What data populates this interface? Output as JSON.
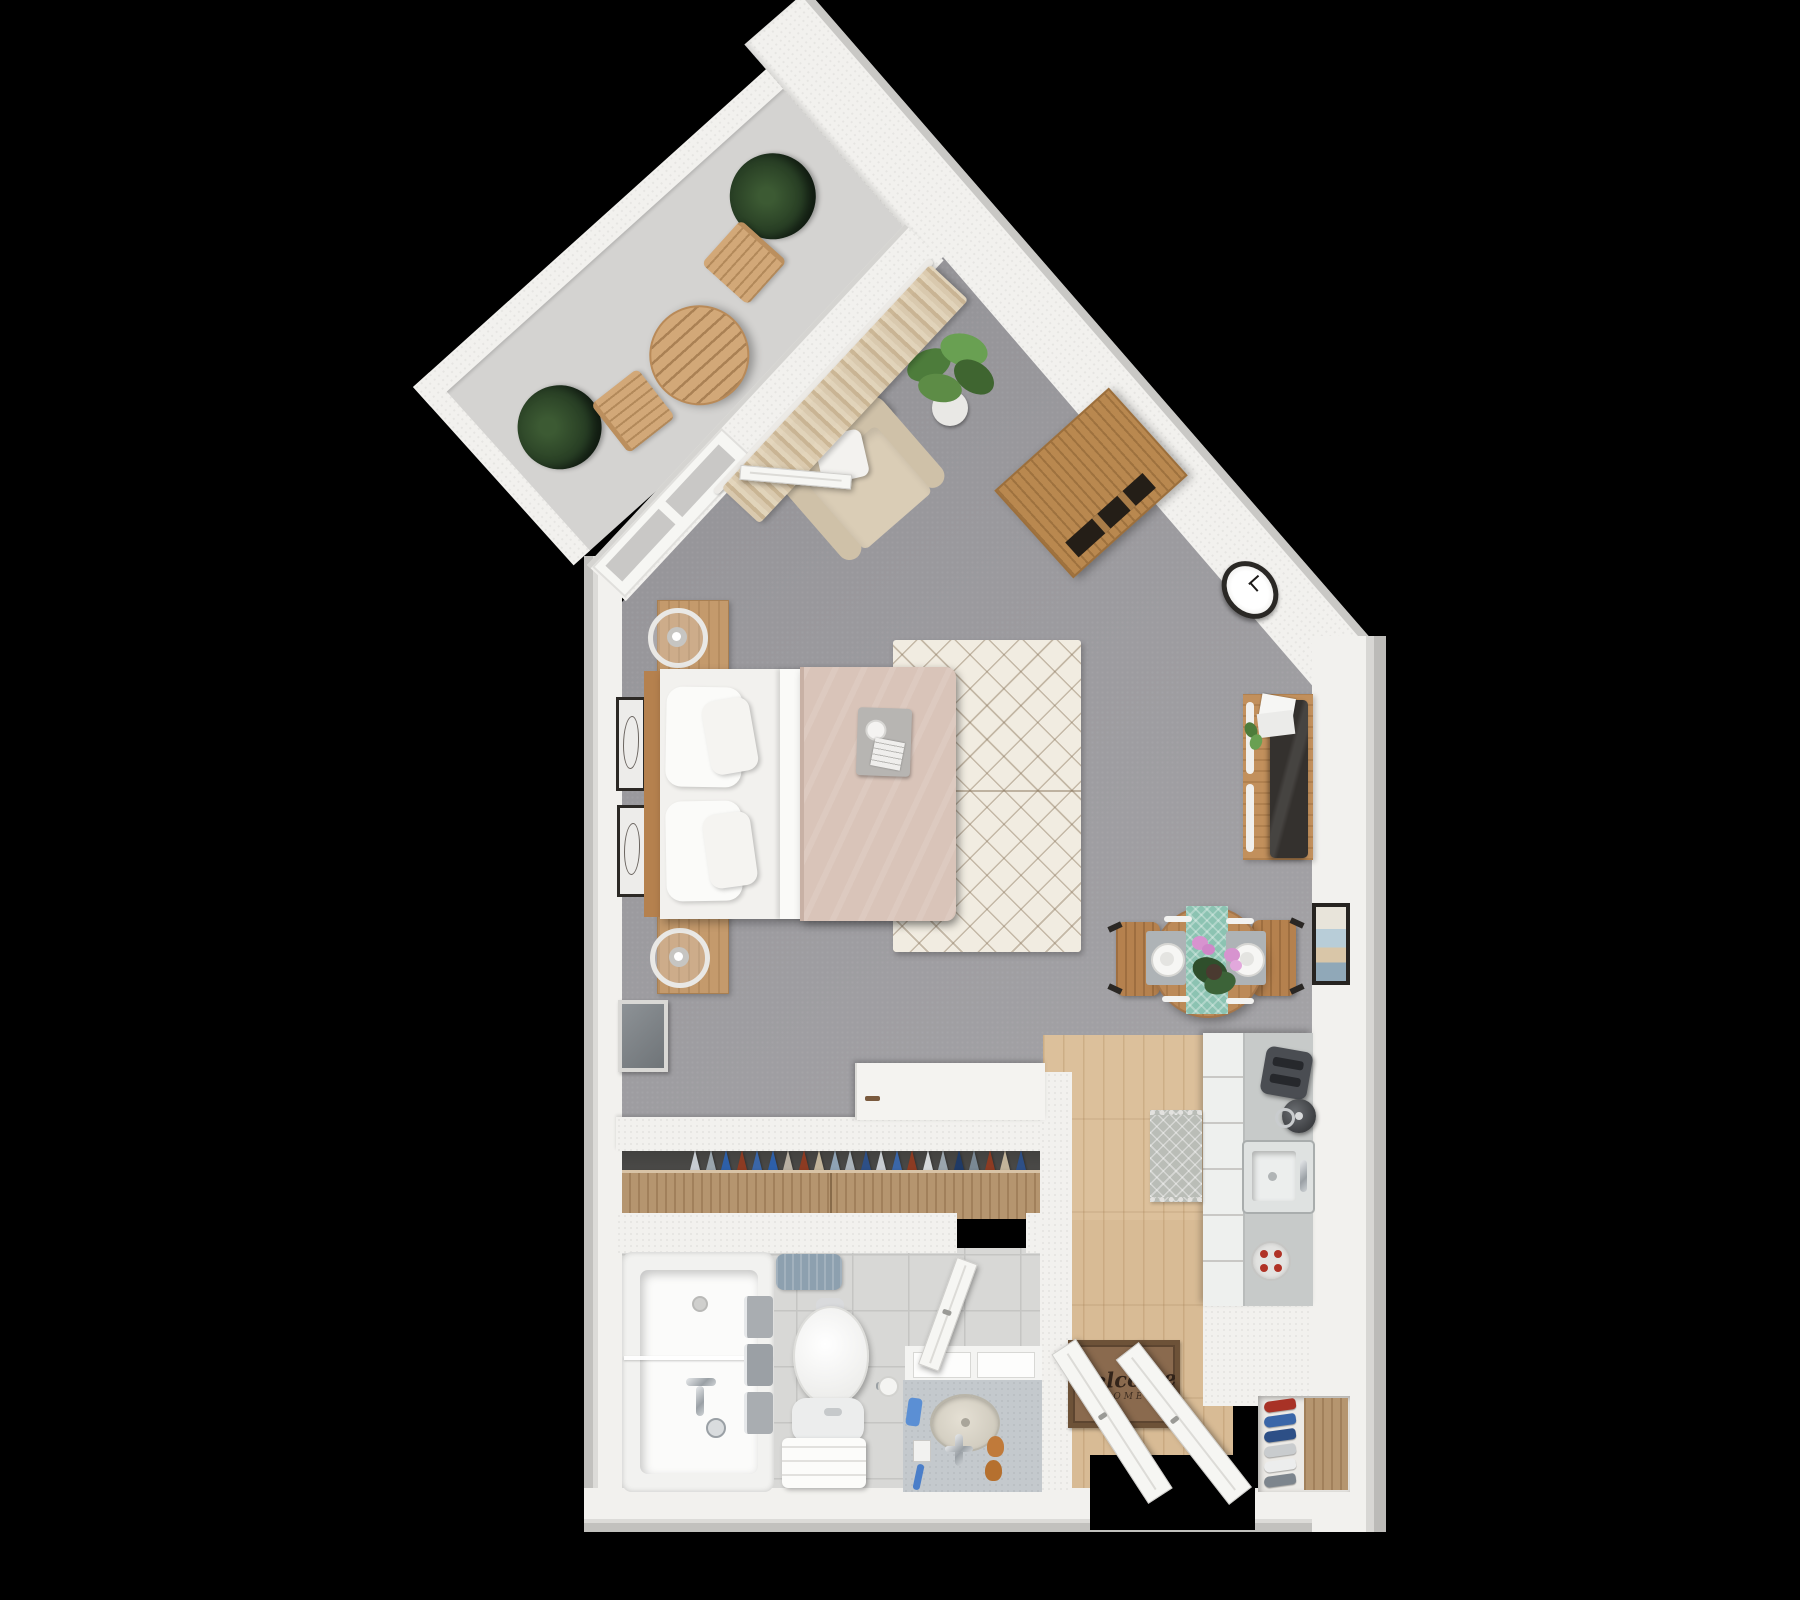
{
  "scene": {
    "type": "3d-floor-plan",
    "subject": "studio apartment top-down architectural render",
    "background": "#000000"
  },
  "entry_mat": {
    "text": "Welcome",
    "sub_text": "HOME"
  },
  "palette": {
    "wall": "#f2f1ee",
    "wall_rim": "#c7c6c3",
    "carpet": "#9b9a9e",
    "balcony_floor": "#d4d3d1",
    "wood_furniture": "#c49a6c",
    "wood_dark": "#b5814e",
    "kitchen_floor": "#dcc09b",
    "closet_dresser": "#b5956f",
    "rug": "#f1ece1",
    "rug_pattern": "#a2927e",
    "bed_blanket": "#d9c4b9",
    "linen_white": "#f5f4f2",
    "armchair": "#d7c9b1",
    "curtain": "#d8c7ab",
    "plant_dark": "#2c4427",
    "plant_light": "#5d8c46",
    "table_runner": "#8cc3b2",
    "orchid_pink": "#d793cf",
    "counter_gray": "#c7cac9",
    "appliance_dark": "#4a4d52",
    "burner_red": "#b03226",
    "tile": "#d8d8d6",
    "marble": "#c4c9cd",
    "towel_gray": "#a9adb1",
    "bath_mat": "#8da0af",
    "mat_brown": "#8a6a4e",
    "tv_black": "#34312e",
    "clock_rim": "#2a2825",
    "door_white": "#f6f6f3"
  },
  "closet": {
    "clothes_colors": [
      "#c8cdd2",
      "#9aa5ad",
      "#2d5fa8",
      "#8d3b22",
      "#3a66a8",
      "#2d5fa8",
      "#b9b0a2",
      "#8d3b22",
      "#c2b49a",
      "#8fa3b5",
      "#aab3ba",
      "#2d4f86",
      "#c8cdd2",
      "#3a66a8",
      "#8d3b22",
      "#d5d8da",
      "#9aa5ad",
      "#1f3a66",
      "#7a8894",
      "#8d3b22",
      "#c2b49a",
      "#2d4f86"
    ]
  },
  "entry_closet": {
    "shoe_colors": [
      "#a83226",
      "#3a66a8",
      "#2d4f86",
      "#c9ccce",
      "#eceded",
      "#7d858d"
    ]
  },
  "inventory": [
    "balcony bistro table",
    "balcony folding chairs",
    "potted plants",
    "sheer curtains",
    "french balcony door",
    "armchair with throw pillow",
    "angled wood cabinet",
    "wall clock",
    "double bed with tan duvet",
    "nightstands with ring lamps",
    "framed wall art",
    "moroccan area rug",
    "leaning floor mirror",
    "tv console with flat tv",
    "gallery frame",
    "round dining table for two",
    "teal table runner",
    "orchid centerpiece",
    "kitchen counter with drawers",
    "toaster",
    "kettle",
    "kitchen sink",
    "electric cooktop",
    "kitchen runner mat",
    "open wardrobe with hanging clothes",
    "white dresser",
    "bathtub with glass screen",
    "towel rail",
    "toilet with towel bench",
    "marble vanity with round sink",
    "welcome door mat",
    "entry double doors",
    "shoe alcove"
  ]
}
